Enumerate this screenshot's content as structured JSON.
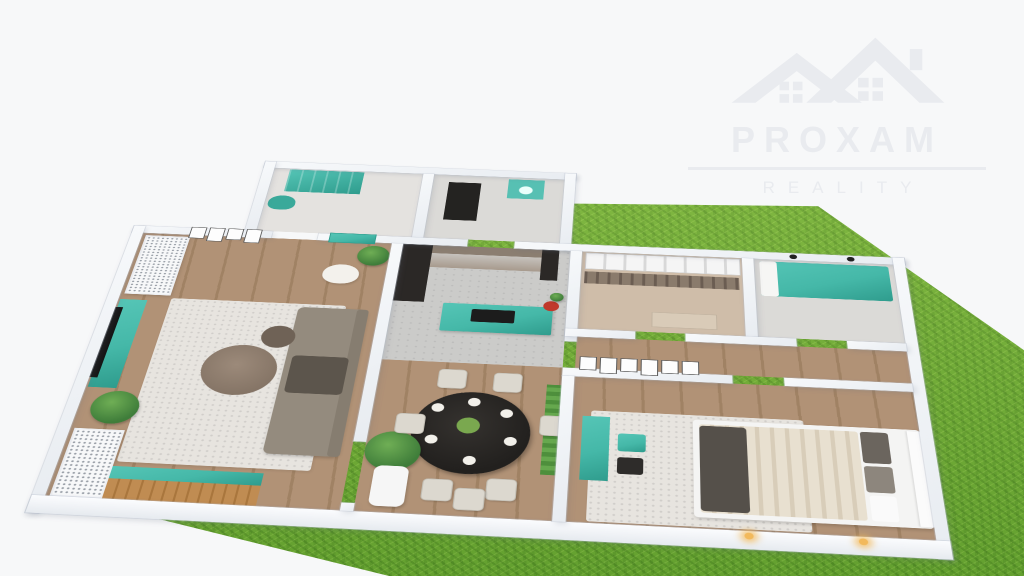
{
  "watermark": {
    "brand": "PROXAM",
    "tagline": "REALITY",
    "logo_icon": "house-roofs-icon"
  },
  "colors": {
    "background": "#f7f8f9",
    "grass": "#74b437",
    "wall": "#f2f4f7",
    "floor_wood": "#b19276",
    "floor_wood_dark": "#a08264",
    "teal": "#45b8a8",
    "teal_dark": "#2f9c8d",
    "wood_drawer": "#c08c52",
    "sofa": "#948b7e",
    "table_black": "#22201e",
    "cabinet_taupe": "#9d9083",
    "dark_unit": "#2b2826",
    "rug": "#e7e4df",
    "watermark": "#e9ebef",
    "lamp_glow": "#f2b95c"
  },
  "scene": {
    "type": "3d-floor-plan-render",
    "rooms": [
      {
        "name": "living-room",
        "furniture": [
          "wall-tv",
          "teal-tv-stand",
          "gray-corner-sofa",
          "round-coffee-tables",
          "light-rug",
          "teal-wood-sideboard",
          "perforated-cabinets",
          "potted-plants",
          "wall-shelves-and-frames",
          "white-armchair"
        ]
      },
      {
        "name": "kitchen",
        "furniture": [
          "taupe-back-cabinets",
          "dark-tall-units",
          "teal-island-with-cooktop",
          "flowers"
        ]
      },
      {
        "name": "dining-room",
        "furniture": [
          "black-round-table",
          "white-chairs",
          "tall-white-planter",
          "vertical-garden"
        ]
      },
      {
        "name": "walk-in-closet",
        "furniture": [
          "white-storage-boxes",
          "hanging-clothes-rail",
          "dresser"
        ]
      },
      {
        "name": "second-bedroom",
        "furniture": [
          "teal-bed",
          "wall-lamps"
        ]
      },
      {
        "name": "hallway",
        "furniture": [
          "gallery-picture-wall",
          "white-door"
        ]
      },
      {
        "name": "master-bedroom",
        "furniture": [
          "white-bed-striped-duvet",
          "dark-pillows",
          "white-rug",
          "teal-console-desk",
          "teal-stool",
          "black-stool",
          "warm-wall-lamps"
        ]
      },
      {
        "name": "kids-room",
        "furniture": [
          "teal-wardrobe",
          "octopus-wall-decal"
        ]
      },
      {
        "name": "bathroom",
        "furniture": [
          "dark-doorway",
          "teal-washer"
        ]
      }
    ],
    "environment": [
      "green-lawn",
      "white-studio-background"
    ]
  }
}
